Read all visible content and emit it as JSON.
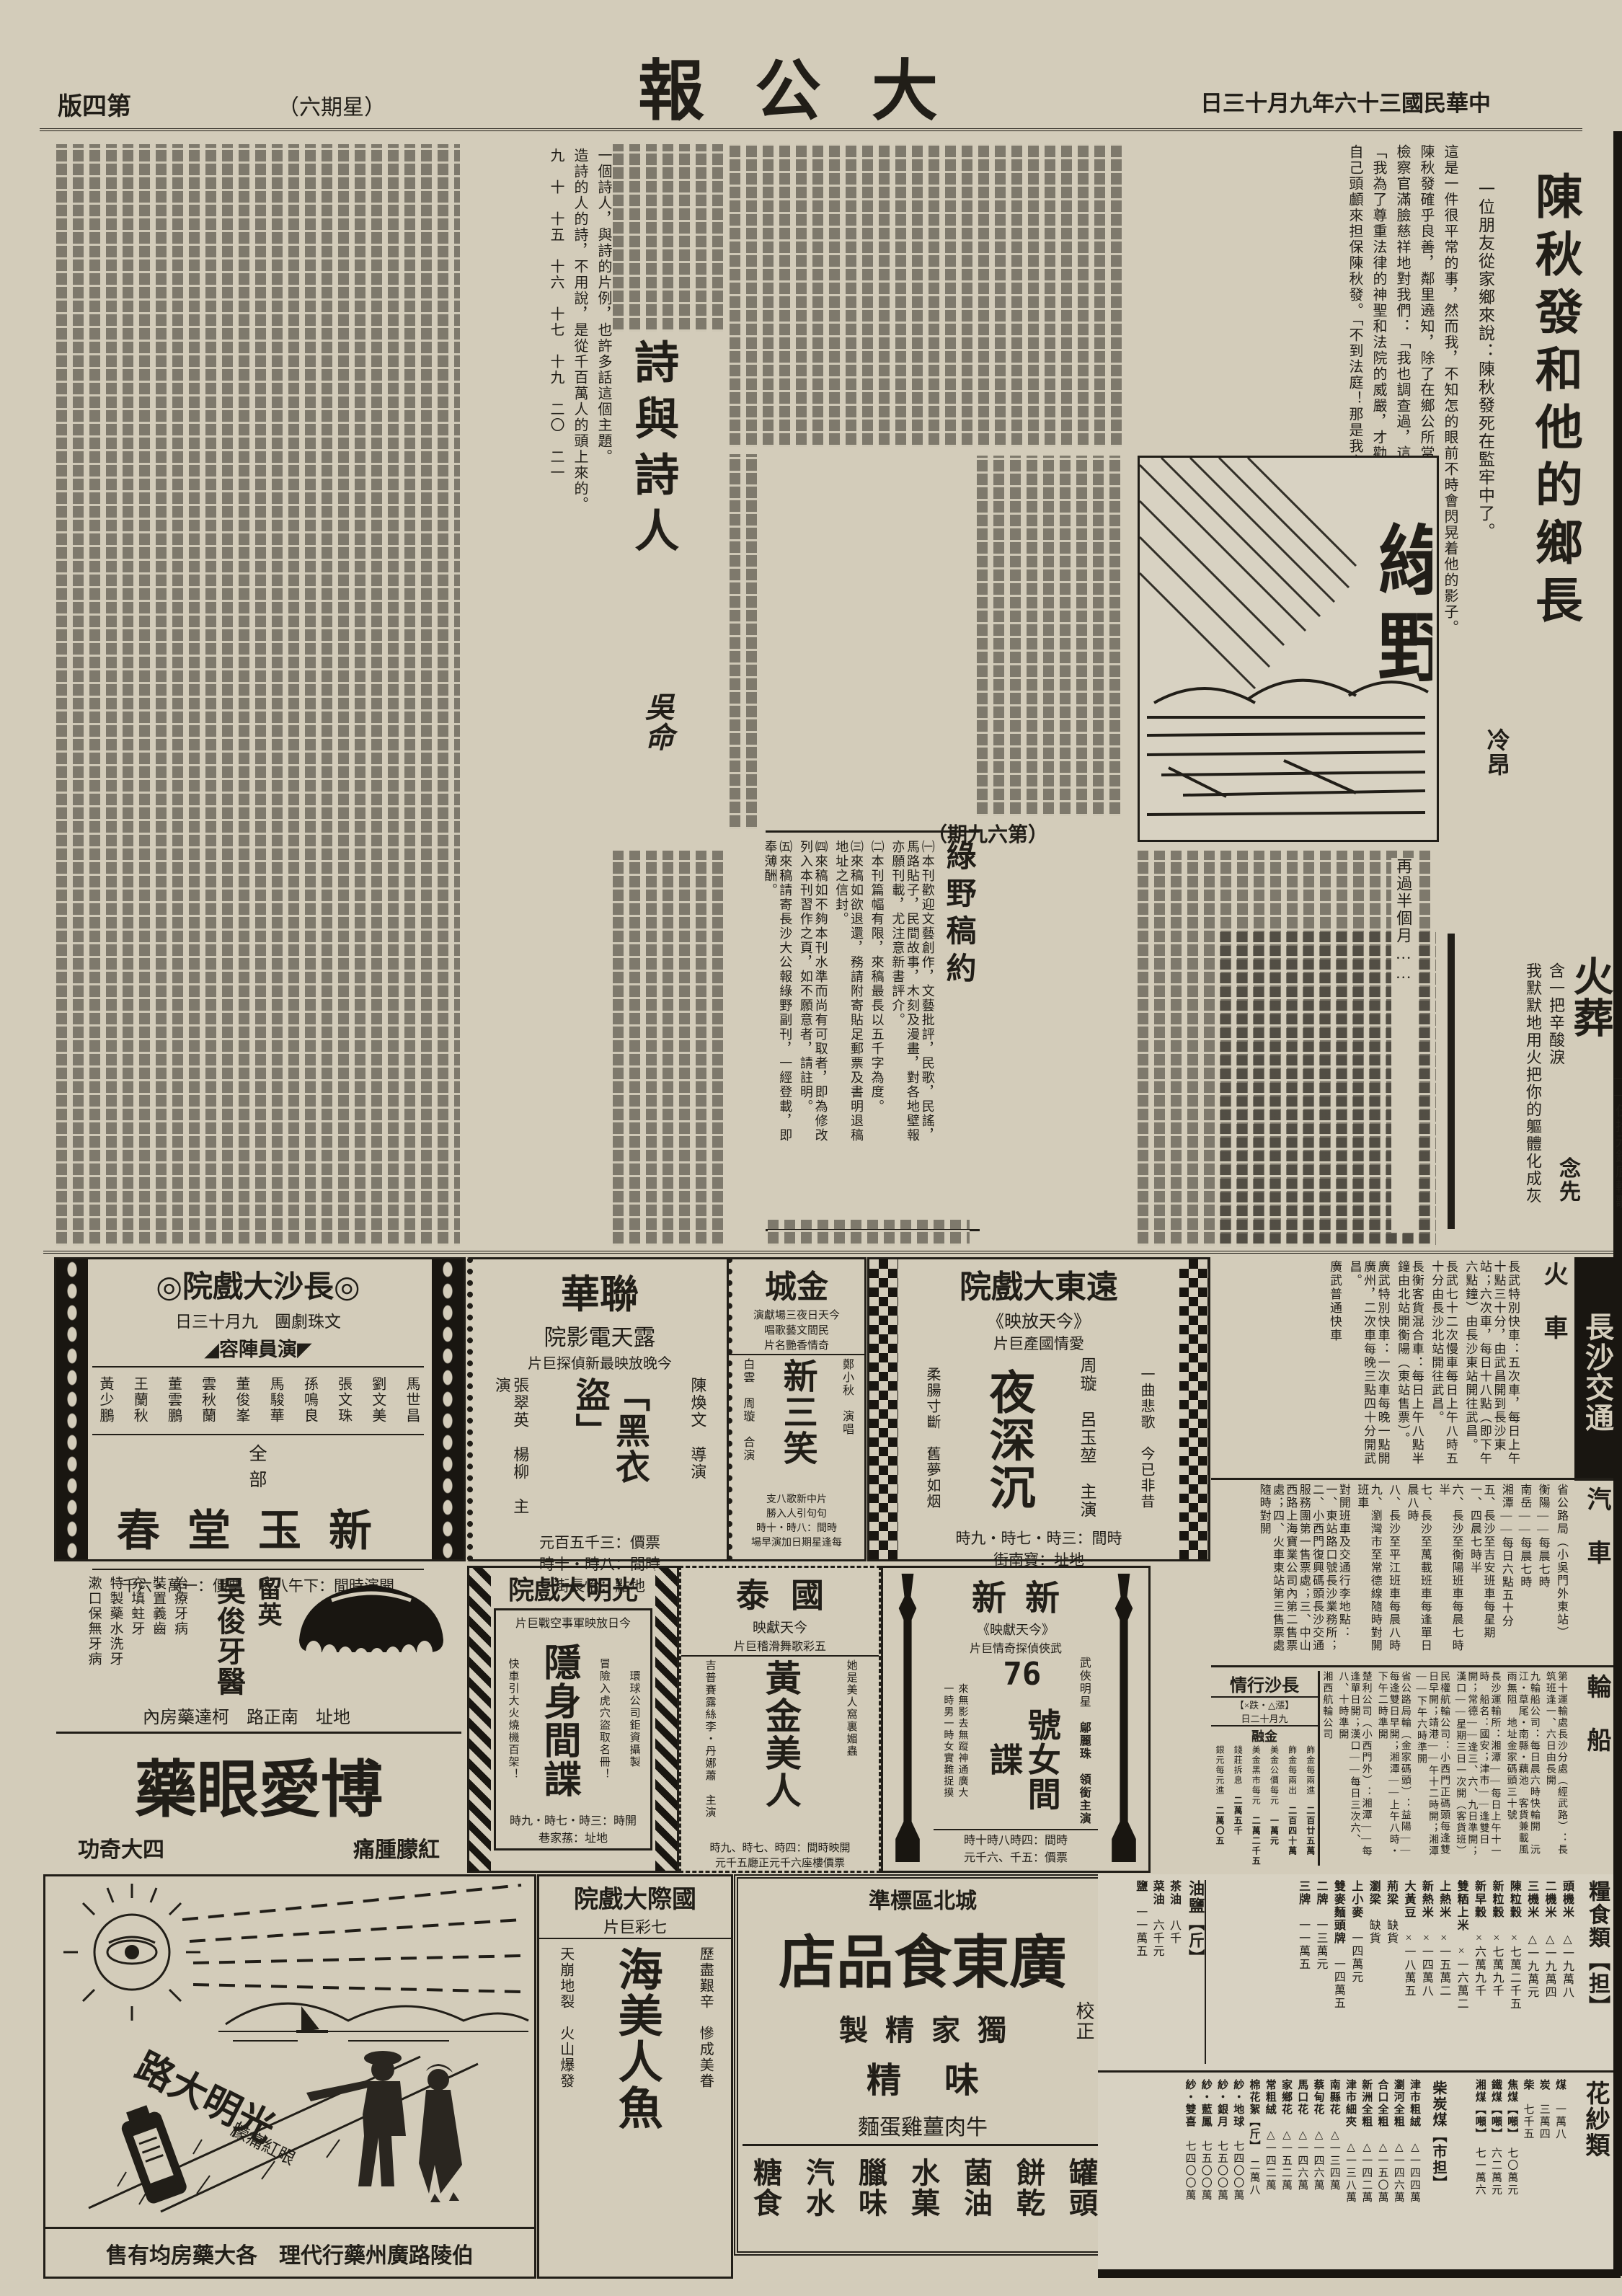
{
  "header": {
    "masthead": "大公報",
    "date": "中華民國三十六年九月十三日",
    "page_label": "第四版",
    "weekday": "（星期六）"
  },
  "chen": {
    "title": "陳秋發和他的鄉長",
    "author": "冷昂",
    "lead": "一位朋友從家鄉來說：陳秋發死在監牢中了。",
    "col1": "這是一件很平常的事，然而我，不知怎的眼前不時會閃晃着他的影子。",
    "col2": "陳秋發確乎良善，鄰里遶知，除了在鄉公所當過二個零月伙頭外，別無幹過壞事。",
    "col3": "檢察官滿臉慈祥地對我們：「我也調查過，這個人確是善良，可是——」",
    "col4": "「我為了尊重法律的神聖和法院的威嚴，才勸他到法院，誰知如此！」",
    "col5": "自己頭顱來担保陳秋發。「不到法庭！那是我害他了——」",
    "col6": "未曾作惡的緣知被誘者，政府也給予寬容……「不錯，政府對於這類人也不致於嚴厲處置的，不過我還是受高等法院……」",
    "col7": "再過半個月……"
  },
  "poetry": {
    "title": "詩與詩人",
    "author": "吳命",
    "col1": "一個詩人，與詩的片例，也許多話這個主題。",
    "col2": "造詩的人的詩，不用說，是從千百萬人的頭上來的。",
    "sections": "九　十　十五　十六　十七　十九　二〇　二一"
  },
  "huozang": {
    "title": "火葬",
    "subtitle": "——伍拾元鈔底輓歌",
    "author": "念先",
    "line1": "含一把辛酸淚",
    "line2": "我默默地用火把你的軀體化成灰"
  },
  "luye": {
    "name": "綠野",
    "issue": "（第六九期）",
    "submission_title": "綠野稿約",
    "rules": [
      "㈠本刊歡迎文藝創作，文藝批評，民歌，民謠，馬路貼子，民間故事，木刻及漫畫，對各地壁報亦願刊載，尤注意新書評介。",
      "㈡本刊篇幅有限，來稿最長以五千字為度。",
      "㈢來稿如欲退還，務請附寄貼足郵票及書明退稿地址之信封。",
      "㈣來稿如不夠本刊水準而尚有可取者，即為修改列入本刊習作之頁，如不願意者，請註明。",
      "㈤來稿請寄長沙大公報綠野副刊，一經登載，即奉薄酬。"
    ]
  },
  "ads": {
    "changsha": {
      "ornament": "◎",
      "name": "長沙大戲院",
      "troupe_date": "文珠劇團　九月十三日",
      "roster_label": "◤演員陣容◢",
      "cast": [
        "馬世昌",
        "劉文美",
        "張文珠",
        "孫鳴良",
        "馬駿華",
        "董俊峯",
        "雲秋蘭",
        "董雲鵬",
        "王蘭秋",
        "黃少鵬"
      ],
      "quanbu": "全部",
      "play": "新玉堂春",
      "bottom": "開演時間：下午八時　票價：一萬・六千"
    },
    "lianhua": {
      "name": "聯華",
      "venue": "露天電影院",
      "tagline": "今晚放映最新偵探巨片",
      "film": "「黑衣盜」",
      "director": "陳煥文　導演",
      "stars": "張翠英　楊柳　主演",
      "price": "票價：三千五百元",
      "time": "時間：八時・十時",
      "address": "地點：怡長街"
    },
    "jincheng": {
      "name": "金城",
      "tagline1": "今天日夜三場獻演",
      "tagline2": "民間文藝歌唱",
      "tagline3": "奇情香艷名片",
      "film": "新三笑",
      "star_right": "鄭小秋　演唱",
      "stars_left": "白雲　周璇　合演",
      "note1": "片中新歌八支",
      "note2": "句句引人入勝",
      "time": "時間：八時・十時",
      "extra": "每逢星期日加演早場"
    },
    "yuandong": {
      "name": "遠東大戲院",
      "today": "《今天放映》",
      "genre": "愛情國產巨片",
      "stars": "周璇　呂玉堃　主演",
      "film": "夜深沉",
      "line1": "一曲悲歌　今已非昔",
      "line2": "柔腸寸斷　舊夢如烟",
      "time": "時間：三時・七時・九時",
      "address": "地址：寶南街"
    },
    "guangming": {
      "name": "光明大戲院",
      "tagline": "今日放映軍事空戰巨片",
      "film": "隱身間諜",
      "note1": "環球公司鉅資攝製",
      "note2": "冒險入虎穴盜取名冊！",
      "note3": "快車引大火燒機百架！",
      "time": "開時：三時・七時・九時",
      "address": "地址：蓀家巷"
    },
    "guotai": {
      "name": "國泰",
      "today": "今天獻映",
      "genre": "五彩歌舞滑稽巨片",
      "film": "黃金美人",
      "tagline_r": "她是美人窩裏媚蟲",
      "tagline_l": "他是黃金城中的大亨",
      "stars": "吉普賽露絲李・丹娜蕭　主演",
      "time": "開映時間：四時、七時、九時",
      "price": "票價樓座六千元正廳五千元"
    },
    "xinxin": {
      "name": "新新",
      "today": "《今天獻映》",
      "genre": "武俠偵探奇情巨片",
      "film_number": "76",
      "film": "號女間諜",
      "star_label": "武俠明星",
      "star": "鄔麗珠　領銜主演",
      "tagline1": "來無影去無蹤神通廣大",
      "tagline2": "一時男一時女實難捉摸",
      "time": "時間：四時八時十時",
      "price": "票價：五千、六千元"
    },
    "intl": {
      "name": "國際大戲院",
      "genre": "七彩巨片",
      "line1": "歷盡艱辛　慘成美眷",
      "line2": "天崩地裂　火山爆發",
      "film": "海美人魚"
    },
    "dental": {
      "line1": "留英",
      "name": "吳俊牙醫",
      "services": [
        "治療牙病",
        "裝置義齒",
        "充填蛀牙",
        "特製藥水洗牙",
        "漱口保無牙病"
      ],
      "address": "地址　南正路　柯達藥房內"
    },
    "boai": {
      "name": "博愛眼藥",
      "right": "紅朦腫痛",
      "left": "四大奇功",
      "slogan": "光明大路",
      "small": "眼紅痛朦",
      "agent": "伯陵路廣州藥行代理　各大藥房均有售"
    },
    "food": {
      "district": "城北區標準",
      "name": "廣東食品店",
      "corner": "校正",
      "usp1": "獨家精製",
      "usp2": "味精",
      "product": "牛肉薑雞蛋麵",
      "items": [
        "罐頭",
        "餅乾",
        "菌油",
        "水菓",
        "臘味",
        "汽水",
        "糖食"
      ]
    }
  },
  "transport": {
    "banner": "長沙交通",
    "train_label": "火車",
    "bus_label": "汽車",
    "ship_label": "輪船",
    "train_items": [
      "長武特別快車：五次車，每日上午十點三十分，由武昌開到長沙東站；六次車，每日十八點（即下午六點鐘）由長沙東站開往武昌。",
      "長武七十二次慢車每日上午八時五十分由長沙北站開往武昌。",
      "長衡客貨混合車：每日上午八點半鐘由北站開衡陽（東站售票）。",
      "廣武特別快車：一次車每晚一點開廣州，二次車每晚三點四十分開武昌。",
      "廣武普通快車"
    ],
    "bus_items": [
      "省公路局（小吳門外東站）",
      "衡陽——每晨七時",
      "南岳——每晨七時",
      "湘潭——每日六點五十分",
      "五、長沙至吉安班車每星期一、四晨七時半",
      "六、長沙至衡陽班車每晨七時半",
      "七、長沙至萬載班車每逢單日晨八時",
      "八、長沙至平江班車每晨八時",
      "九、瀏灣市至常德線隨時對開班車",
      "對開班車及交通行李地點：一、東站路口號長沙業務所；二、小西門復興碼頭長沙交通服務團第一售票處；三、中山西路上海寶業公司內第二售票處；四、火車東站第三售票處隨時對開"
    ],
    "ship_items": [
      "第十運輸處長沙分處（經武路）：長筑班逢一、六日由長開",
      "九輪船公司：每日晨六時快輪開　沅江・草尾・南縣・藕池　客貨兼載風雨無阻　地址金家碼頭三十號",
      "長沙運輸所：湘潭——每日上午十一時　船名：國安；津市——逢雙日開；常德——逢三、六、九日準開；漢口——星期三日一次開（客貨班）",
      "民權航輪公司：小西門正碼頭每逢雙日早開；靖港——午十二時開；湘潭——下午六時準開",
      "省公路局輪（金家碼頭）：益陽——每逢雙日早開；湘潭——上午八時・下午二時準開",
      "楚利公司（小西門外）：湘潭——每逢單日開；漢口——每日三次六、八、十時準開",
      "湘西航輪公司"
    ]
  },
  "market": {
    "title": "長沙行情",
    "note": "【漲△・跌×】",
    "date": "九月十二日",
    "finance_label": "金融",
    "finance": [
      {
        "label": "飾金每兩進",
        "value": "二百廿五萬"
      },
      {
        "label": "飾金每兩出",
        "value": "二百四十萬"
      },
      {
        "label": "美金公價每元",
        "value": "一萬元"
      },
      {
        "label": "美金黑市每元",
        "value": "二萬二千五"
      },
      {
        "label": "錢莊拆息",
        "value": "二萬五千"
      },
      {
        "label": "銀元每元進",
        "value": "二萬〇五"
      }
    ],
    "grain_label": "糧食類【担】",
    "grain": [
      {
        "item": "頭機米",
        "price": "△一九萬八"
      },
      {
        "item": "二機米",
        "price": "△一九萬四"
      },
      {
        "item": "三機米",
        "price": "△一九萬元"
      },
      {
        "item": "陳粒穀",
        "price": "×七萬二千五"
      },
      {
        "item": "新粒穀",
        "price": "×七萬九千"
      },
      {
        "item": "新早穀",
        "price": "×六萬九千"
      },
      {
        "item": "雙粞上米",
        "price": "×一六萬二"
      },
      {
        "item": "上熱米",
        "price": "×一五萬二"
      },
      {
        "item": "新熱米",
        "price": "×一四萬八"
      },
      {
        "item": "大黃豆",
        "price": "×一八萬五"
      },
      {
        "item": "荊梁",
        "price": "缺貨"
      },
      {
        "item": "瀏梁",
        "price": "缺貨"
      },
      {
        "item": "上小麥",
        "price": "一四萬元"
      },
      {
        "item": "雙麥麵頭牌",
        "price": "一四萬五"
      },
      {
        "item": "二牌",
        "price": "一三萬元"
      },
      {
        "item": "三牌",
        "price": "一一萬五"
      }
    ],
    "oil_label": "油鹽【斤】",
    "oil": [
      {
        "item": "茶油",
        "price": "八千"
      },
      {
        "item": "菜油",
        "price": "六千元"
      },
      {
        "item": "鹽",
        "price": "一一萬五"
      }
    ],
    "fuel_label": "柴炭煤【市担】",
    "fuel": [
      {
        "item": "煤",
        "price": "一萬八"
      },
      {
        "item": "炭",
        "price": "三萬四"
      },
      {
        "item": "柴",
        "price": "七千五"
      },
      {
        "item": "焦煤【噸】",
        "price": "七〇萬元"
      },
      {
        "item": "鐵煤【噸】",
        "price": "六二萬元"
      },
      {
        "item": "湘煤【噸】",
        "price": "七一萬六"
      }
    ],
    "cotton_label": "花紗類",
    "cotton": [
      {
        "item": "津市粗絨",
        "price": "△一四四萬"
      },
      {
        "item": "瀏河全粗",
        "price": "△一四六萬"
      },
      {
        "item": "合口全粗",
        "price": "△一五〇萬"
      },
      {
        "item": "新洲全粗",
        "price": "△一四二萬"
      },
      {
        "item": "津市細夾",
        "price": "△一三八萬"
      },
      {
        "item": "南縣花",
        "price": "△一三四萬"
      },
      {
        "item": "蔡甸花",
        "price": "△一四六萬"
      },
      {
        "item": "馬口花",
        "price": "△一四六萬"
      },
      {
        "item": "家鄉花",
        "price": "△一五二萬"
      },
      {
        "item": "常粗絨",
        "price": "△一四二萬"
      },
      {
        "item": "棉花絮【斤】",
        "price": "二萬八"
      },
      {
        "item": "紗・地球",
        "price": "七四〇〇萬"
      },
      {
        "item": "紗・銀月",
        "price": "七五〇〇萬"
      },
      {
        "item": "紗・藍鳳",
        "price": "七五〇〇萬"
      },
      {
        "item": "紗・雙喜",
        "price": "七四〇〇萬"
      }
    ]
  }
}
